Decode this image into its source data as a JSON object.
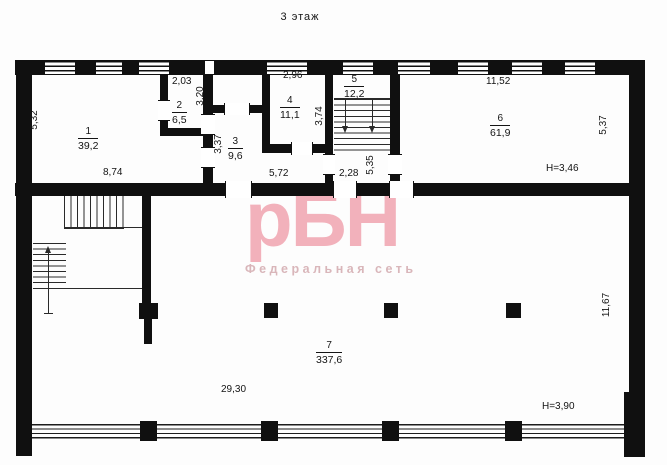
{
  "title": "3 этаж",
  "watermark": {
    "logo": "рБН",
    "subtitle": "Федеральная сеть"
  },
  "rooms": [
    {
      "number": "1",
      "area": "39,2"
    },
    {
      "number": "2",
      "area": "6,5"
    },
    {
      "number": "3",
      "area": "9,6"
    },
    {
      "number": "4",
      "area": "11,1"
    },
    {
      "number": "5",
      "area": "12,2"
    },
    {
      "number": "6",
      "area": "61,9"
    },
    {
      "number": "7",
      "area": "337,6"
    }
  ],
  "dims": {
    "room1_width": "8,74",
    "room1_height": "5,32",
    "room2_width": "2,03",
    "room2_height": "3,20",
    "room3_height": "3,37",
    "corridor_width": "5,72",
    "room4_width": "2,96",
    "room4_height": "3,74",
    "room5_width": "2,28",
    "room5_height": "5,35",
    "room6_width": "11,52",
    "room6_height": "5,37",
    "room7_width": "29,30",
    "room7_height": "11,67",
    "height_top": "H=3,46",
    "height_bottom": "H=3,90"
  },
  "colors": {
    "wall": "#101010",
    "watermark_logo": "#f2b1bb",
    "watermark_subtitle": "#d9b6ba"
  }
}
